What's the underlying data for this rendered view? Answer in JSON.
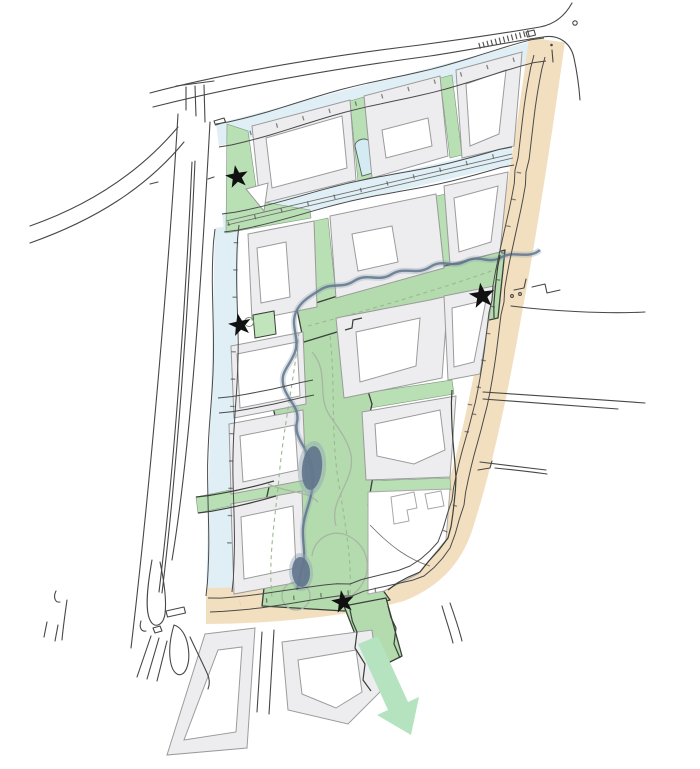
{
  "map": {
    "type": "urban-masterplan-site-plan",
    "features": [
      "perimeter-boulevard",
      "canal-streets",
      "green-corridor",
      "stream",
      "ponds",
      "city-blocks",
      "courtyards",
      "star-markers",
      "flow-arrow"
    ],
    "star_count": 4
  },
  "colors": {
    "bg": "#ffffff",
    "green": "#b9dfb4",
    "park": "#b3dbae",
    "blue": "#dfeff5",
    "lane": "#d5ebf3",
    "beige": "#f2dfbf",
    "block": "#ededef",
    "blockStroke": "#9b9b9b",
    "court": "#ffffff",
    "water": "#60748c",
    "waterHalo": "#93a5b4",
    "dark": "#3a4038",
    "road": "#474747",
    "dash": "#9eb794",
    "grayPath": "#a9b5a4",
    "arrow": "#b5e3c0",
    "star": "#111111"
  },
  "markers": {
    "stars": [
      {
        "transform": "translate(237,177) rotate(-10)"
      },
      {
        "transform": "translate(240,325) rotate(-12)"
      },
      {
        "transform": "translate(482,296) rotate(-8) scale(1.12)"
      },
      {
        "transform": "translate(343,602) rotate(-10)"
      }
    ]
  },
  "arrow": {
    "transform": "translate(0,0)"
  }
}
